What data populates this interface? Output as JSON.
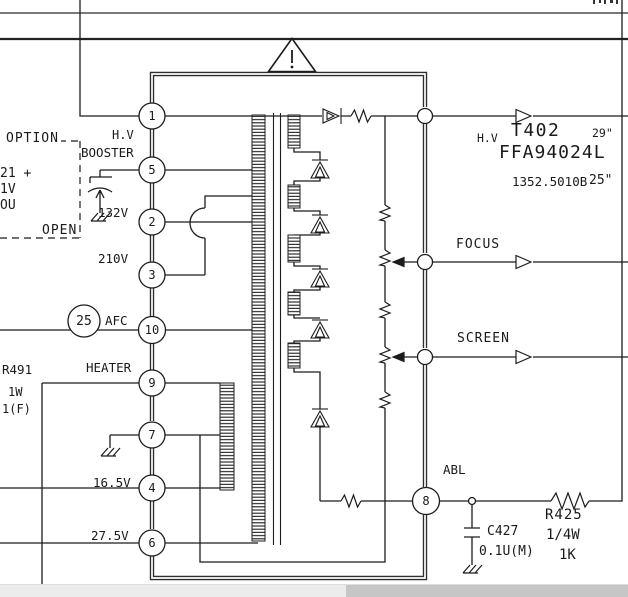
{
  "transformer": {
    "designator": "T402",
    "part_number": "FFA94024L",
    "alt_part_number": "1352.5010B",
    "screen_size_1": "29\"",
    "screen_size_2": "25\"",
    "hv_output_label": "H.V"
  },
  "pins": {
    "p1": "1",
    "p5": "5",
    "p2": "2",
    "p3": "3",
    "p10": "10",
    "p9": "9",
    "p7": "7",
    "p4": "4",
    "p6": "6",
    "p8": "8"
  },
  "pin_labels": {
    "hv": "H.V",
    "booster": "BOOSTER",
    "v132": "132V",
    "v210": "210V",
    "afc": "AFC",
    "heater": "HEATER",
    "v16_5": "16.5V",
    "v27_5": "27.5V",
    "abl": "ABL"
  },
  "outputs": {
    "focus": "FOCUS",
    "screen": "SCREEN"
  },
  "callout": "25",
  "option_box": {
    "title": "OPTION",
    "state": "OPEN",
    "fragment_line1": "21 +",
    "fragment_line2": "1V",
    "fragment_line3": "OU"
  },
  "components": {
    "r491": {
      "ref": "R491",
      "wattage": "1W",
      "tolerance": "1(F)"
    },
    "c427": {
      "ref": "C427",
      "value": "0.1U(M)"
    },
    "r425": {
      "ref": "R425",
      "wattage": "1/4W",
      "value": "1K"
    }
  }
}
